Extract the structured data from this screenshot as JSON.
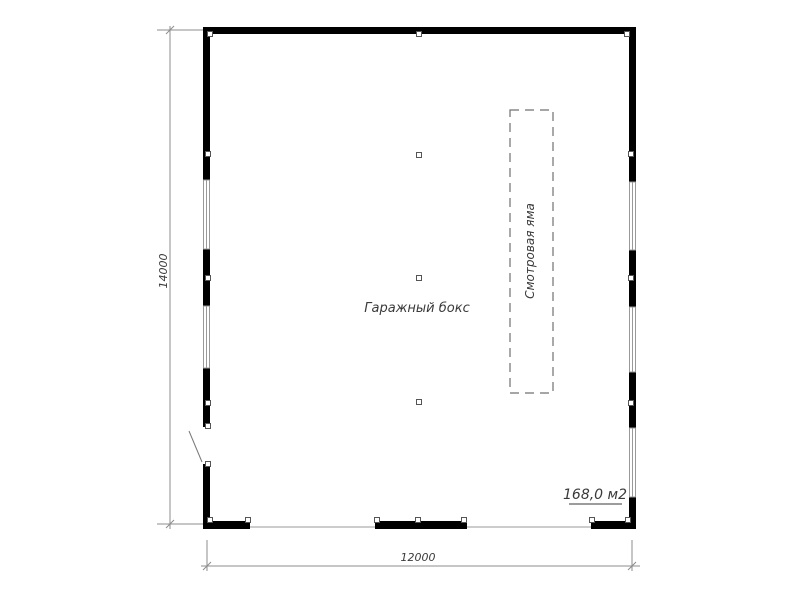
{
  "drawing": {
    "title": "Garage box floor plan",
    "room_label": "Гаражный бокс",
    "pit_label": "Смотровая яма",
    "area_label": "168,0 м2",
    "dim_vertical": "14000",
    "dim_horizontal": "12000"
  },
  "colors": {
    "background": "#ffffff",
    "wall": "#000000",
    "dimension_line": "#8c8c8c",
    "window_line": "#999999",
    "marker_outline": "#555555",
    "pit_outline": "#707070",
    "door_swing": "#787878",
    "label_text": "#3a3a3a"
  }
}
